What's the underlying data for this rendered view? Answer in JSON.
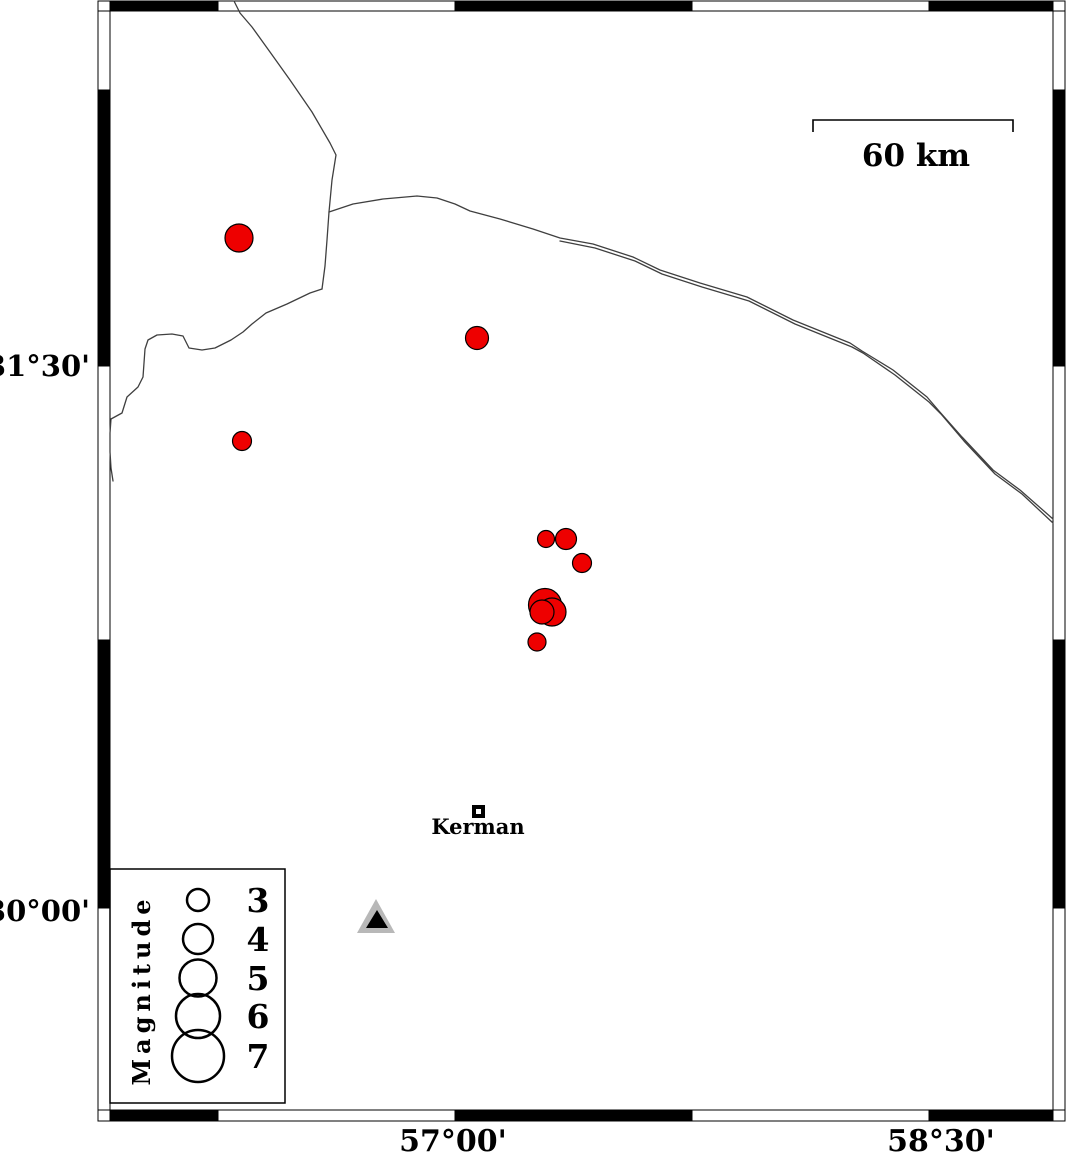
{
  "figure": {
    "width": 1066,
    "height": 1156
  },
  "colors": {
    "earthquake_fill": "#ee0000",
    "marker_stroke": "#000000",
    "boundary_line": "#3f3f3f",
    "station_outer": "#b8b8b8",
    "station_inner": "#000000",
    "frame_black": "#000000",
    "frame_white": "#ffffff"
  },
  "frame": {
    "band_left_x": 98,
    "band_right_x": 1053,
    "band_width": 12,
    "band_top_y": 1,
    "band_top_h": 10,
    "band_bottom_y": 1110,
    "band_bottom_h": 11,
    "x_ticks": [
      110,
      218,
      455,
      692,
      929,
      1053
    ],
    "y_ticks": [
      11,
      90,
      366,
      640,
      908,
      1110
    ]
  },
  "axis": {
    "left": [
      {
        "text": "31°30'",
        "x": 90,
        "y": 376
      },
      {
        "text": "30°00'",
        "x": 90,
        "y": 921
      }
    ],
    "bottom": [
      {
        "text": "57°00'",
        "x": 453,
        "y": 1151
      },
      {
        "text": "58°30'",
        "x": 941,
        "y": 1151
      }
    ]
  },
  "scale_bar": {
    "label": "60 km",
    "x1": 813,
    "x2": 1013,
    "y_top": 120,
    "tick_height": 12,
    "label_x": 916,
    "label_y": 166
  },
  "city": {
    "label": "Kerman",
    "marker_x": 474,
    "marker_y": 807,
    "marker_size": 9,
    "marker_stroke_width": 4,
    "label_x": 478,
    "label_y": 834
  },
  "station": {
    "outer_points": "376,899 357,933 395,933",
    "inner_points": "377,910 366,928 388,928"
  },
  "legend": {
    "title": "Magnitude",
    "box": {
      "x": 110,
      "y": 869,
      "w": 175,
      "h": 234
    },
    "title_x": 150,
    "title_y": 990,
    "circle_cx": 198,
    "num_x": 258,
    "entries": [
      {
        "label": "3",
        "cy": 900,
        "d": 22
      },
      {
        "label": "4",
        "cy": 939,
        "d": 30
      },
      {
        "label": "5",
        "cy": 978,
        "d": 37
      },
      {
        "label": "6",
        "cy": 1016,
        "d": 44
      },
      {
        "label": "7",
        "cy": 1056,
        "d": 52
      }
    ]
  },
  "earthquakes": [
    {
      "cx": 239,
      "cy": 238,
      "d": 28
    },
    {
      "cx": 477,
      "cy": 338,
      "d": 23
    },
    {
      "cx": 242,
      "cy": 441,
      "d": 19
    },
    {
      "cx": 546,
      "cy": 539,
      "d": 17
    },
    {
      "cx": 566,
      "cy": 539,
      "d": 21
    },
    {
      "cx": 582,
      "cy": 563,
      "d": 19
    },
    {
      "cx": 545,
      "cy": 605,
      "d": 33
    },
    {
      "cx": 552,
      "cy": 612,
      "d": 28
    },
    {
      "cx": 542,
      "cy": 612,
      "d": 24
    },
    {
      "cx": 537,
      "cy": 642,
      "d": 18
    }
  ],
  "boundaries": [
    {
      "name": "boundary-north",
      "points": [
        [
          234,
          1
        ],
        [
          240,
          13
        ],
        [
          252,
          27
        ],
        [
          270,
          52
        ],
        [
          290,
          80
        ],
        [
          312,
          112
        ],
        [
          330,
          143
        ],
        [
          336,
          155
        ],
        [
          332,
          180
        ],
        [
          329,
          212
        ],
        [
          327,
          240
        ],
        [
          325,
          266
        ],
        [
          322,
          289
        ]
      ]
    },
    {
      "name": "boundary-west",
      "points": [
        [
          322,
          289
        ],
        [
          310,
          293
        ],
        [
          287,
          304
        ],
        [
          266,
          313
        ],
        [
          252,
          324
        ],
        [
          243,
          332
        ],
        [
          231,
          340
        ],
        [
          215,
          348
        ],
        [
          202,
          350
        ],
        [
          189,
          348
        ],
        [
          183,
          336
        ],
        [
          172,
          334
        ],
        [
          157,
          335
        ],
        [
          148,
          340
        ],
        [
          145,
          349
        ],
        [
          143,
          377
        ],
        [
          138,
          387
        ],
        [
          127,
          397
        ],
        [
          122,
          413
        ],
        [
          111,
          419
        ],
        [
          110,
          433
        ],
        [
          110,
          452
        ],
        [
          111,
          468
        ],
        [
          113,
          481
        ]
      ]
    },
    {
      "name": "boundary-east-1",
      "points": [
        [
          329,
          212
        ],
        [
          353,
          204
        ],
        [
          383,
          199
        ],
        [
          417,
          196
        ],
        [
          437,
          198
        ],
        [
          455,
          204
        ],
        [
          470,
          211
        ],
        [
          500,
          219
        ],
        [
          533,
          229
        ],
        [
          560,
          238
        ],
        [
          593,
          244
        ],
        [
          633,
          257
        ],
        [
          660,
          270
        ],
        [
          700,
          283
        ],
        [
          747,
          297
        ],
        [
          793,
          320
        ],
        [
          850,
          343
        ],
        [
          862,
          351
        ],
        [
          893,
          370
        ],
        [
          927,
          397
        ],
        [
          939,
          411
        ],
        [
          962,
          437
        ],
        [
          993,
          470
        ],
        [
          1020,
          490
        ],
        [
          1053,
          519
        ]
      ]
    },
    {
      "name": "boundary-east-2",
      "points": [
        [
          560,
          241
        ],
        [
          595,
          248
        ],
        [
          635,
          261
        ],
        [
          662,
          274
        ],
        [
          702,
          287
        ],
        [
          749,
          301
        ],
        [
          795,
          324
        ],
        [
          852,
          347
        ],
        [
          863,
          353
        ],
        [
          895,
          375
        ],
        [
          929,
          402
        ],
        [
          941,
          414
        ],
        [
          964,
          441
        ],
        [
          995,
          474
        ],
        [
          1022,
          494
        ],
        [
          1053,
          523
        ]
      ]
    }
  ]
}
